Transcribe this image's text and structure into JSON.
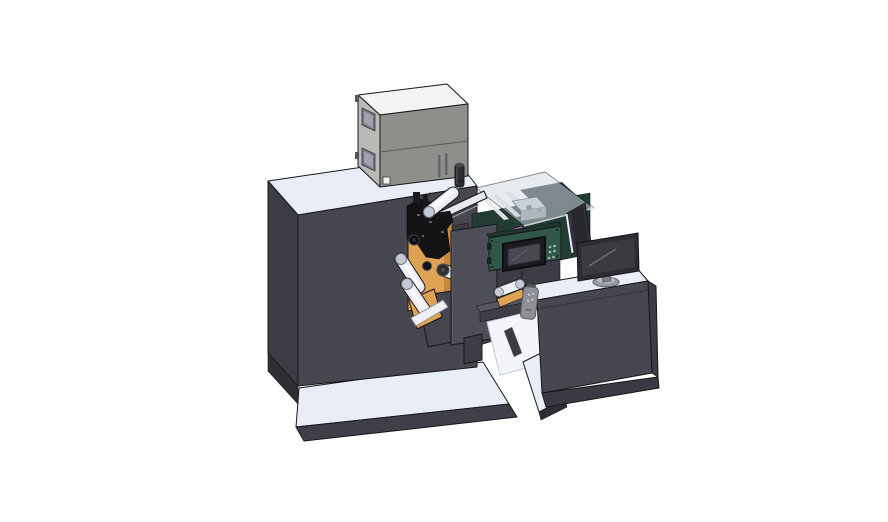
{
  "title": "3D CAD rendering of a roll-fed digital label press with top electronics box, unwind rollers, print engine bay, touch control panel and operator desk with monitor",
  "palette": {
    "bg": "#ffffff",
    "outline": "#17171a",
    "topLight": "#e9edf8",
    "darkFront": "#47474f",
    "darkSide": "#3c3c44",
    "darkDeep": "#2e2e35",
    "darkBand": "#3f3f47",
    "boxTop": "#f4f4f2",
    "boxLeft": "#b9b9b5",
    "boxFront": "#8e8e8a",
    "boxWindow": "#777780",
    "orange": "#dfa254",
    "orangeDark": "#c07f33",
    "teal": "#30584a",
    "tealDeep": "#1e352d",
    "compartmentDark": "#233c33",
    "compartmentInner": "#2c3a38",
    "glass": "#cfd8e2",
    "railLight": "#e6e8ee",
    "rollerLight": "#eceef4",
    "rollerShade": "#c6cad6",
    "magenta": "#c46ac0",
    "plate": "#4e4e58",
    "shelf": "#45454d",
    "beamTop": "#565660",
    "beamFront": "#3e3e47",
    "whiteSoft": "#f3f5fa",
    "screenBezel": "#1c1c20",
    "screenFace": "#484850",
    "sidePanel": "#32323a",
    "monitorFrame": "#2c2c32",
    "monitorScreen": "#3a3a41",
    "standGray": "#9a9aa2",
    "remoteGray": "#8f9095",
    "black": "#141417"
  },
  "scene": {
    "background": "plain white, no floor shadow",
    "parts": [
      {
        "id": "machine-base-platform",
        "label": "white base platform slab"
      },
      {
        "id": "main-cabinet",
        "label": "large dark press cabinet"
      },
      {
        "id": "top-printer-box",
        "label": "gray electronics enclosure on cabinet top"
      },
      {
        "id": "exhaust-cylinder",
        "label": "small black cylinder on cabinet top"
      },
      {
        "id": "engine-bay",
        "label": "clear-cover print engine compartment"
      },
      {
        "id": "print-mechanism",
        "label": "black print head cluster with rail"
      },
      {
        "id": "unwind-rollers",
        "label": "white media rollers on orange plate"
      },
      {
        "id": "carriage-plate",
        "label": "dark front carriage plate"
      },
      {
        "id": "transfer-bridge",
        "label": "web transfer bridge with roller"
      },
      {
        "id": "control-panel",
        "label": "teal HMI panel with screen and buttons"
      },
      {
        "id": "handheld-remote",
        "label": "gray handheld pendant"
      },
      {
        "id": "side-screen-panel",
        "label": "thin dark side screen"
      },
      {
        "id": "operator-monitor",
        "label": "desktop monitor on stand"
      },
      {
        "id": "desk-console",
        "label": "dark operator desk with white top"
      },
      {
        "id": "desk-base-slab",
        "label": "white base slab under desk"
      }
    ]
  }
}
